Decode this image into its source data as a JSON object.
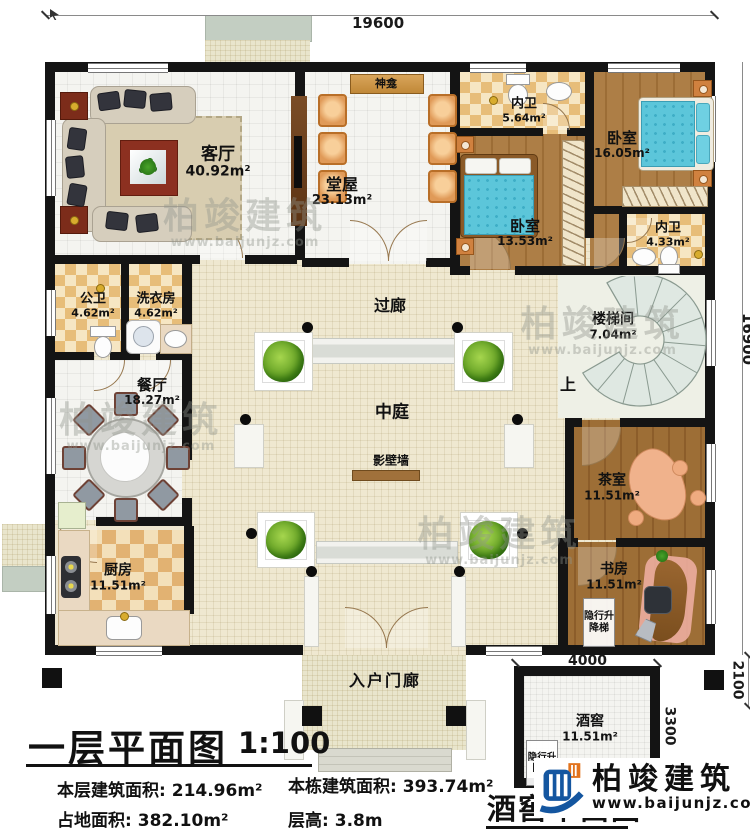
{
  "plan": {
    "title": "一层平面图",
    "scale": "1:100",
    "cellar_title": "酒窖平面图"
  },
  "stats": [
    {
      "label": "本层建筑面积:",
      "value": "214.96m²"
    },
    {
      "label": "本栋建筑面积:",
      "value": "393.74m²"
    },
    {
      "label": "占地面积:",
      "value": "382.10m²"
    },
    {
      "label": "层高:",
      "value": "3.8m"
    }
  ],
  "dimensions": {
    "top": "19600",
    "right": "16900",
    "cellar_width": "4000",
    "cellar_depth": "3300",
    "cellar_offset": "2100"
  },
  "rooms": {
    "living": {
      "name": "客厅",
      "area": "40.92m²"
    },
    "shrine": {
      "name": "神龛"
    },
    "hall": {
      "name": "堂屋",
      "area": "23.13m²"
    },
    "ensuite1": {
      "name": "内卫",
      "area": "5.64m²"
    },
    "bedroom1": {
      "name": "卧室",
      "area": "16.05m²"
    },
    "bedroom2": {
      "name": "卧室",
      "area": "13.53m²"
    },
    "ensuite2": {
      "name": "内卫",
      "area": "4.33m²"
    },
    "public_bath": {
      "name": "公卫",
      "area": "4.62m²"
    },
    "laundry": {
      "name": "洗衣房",
      "area": "4.62m²"
    },
    "corridor": {
      "name": "过廊"
    },
    "stairwell": {
      "name": "楼梯间",
      "area": "7.04m²"
    },
    "up": "上",
    "dining": {
      "name": "餐厅",
      "area": "18.27m²"
    },
    "atrium": {
      "name": "中庭"
    },
    "screen_wall": {
      "name": "影壁墙"
    },
    "tea": {
      "name": "茶室",
      "area": "11.51m²"
    },
    "kitchen": {
      "name": "厨房",
      "area": "11.51m²"
    },
    "study": {
      "name": "书房",
      "area": "11.51m²"
    },
    "elevator": {
      "name": "隐行升降梯"
    },
    "porch": {
      "name": "入户门廊"
    },
    "cellar": {
      "name": "酒窖",
      "area": "11.51m²"
    }
  },
  "brand": {
    "name": "柏竣建筑",
    "url": "www.baijunjz.com"
  },
  "watermark": {
    "name": "柏竣建筑",
    "url": "www.baijunjz.com"
  },
  "colors": {
    "wall": "#141414",
    "wood": "#a87b44",
    "tile_checker": "#e7bd79",
    "bed_teal": "#5cc6da",
    "chair_orange": "#e09a58",
    "logo_blue": "#1456a0",
    "logo_orange": "#e2731d",
    "screen_wall_brown": "#a0713b"
  }
}
